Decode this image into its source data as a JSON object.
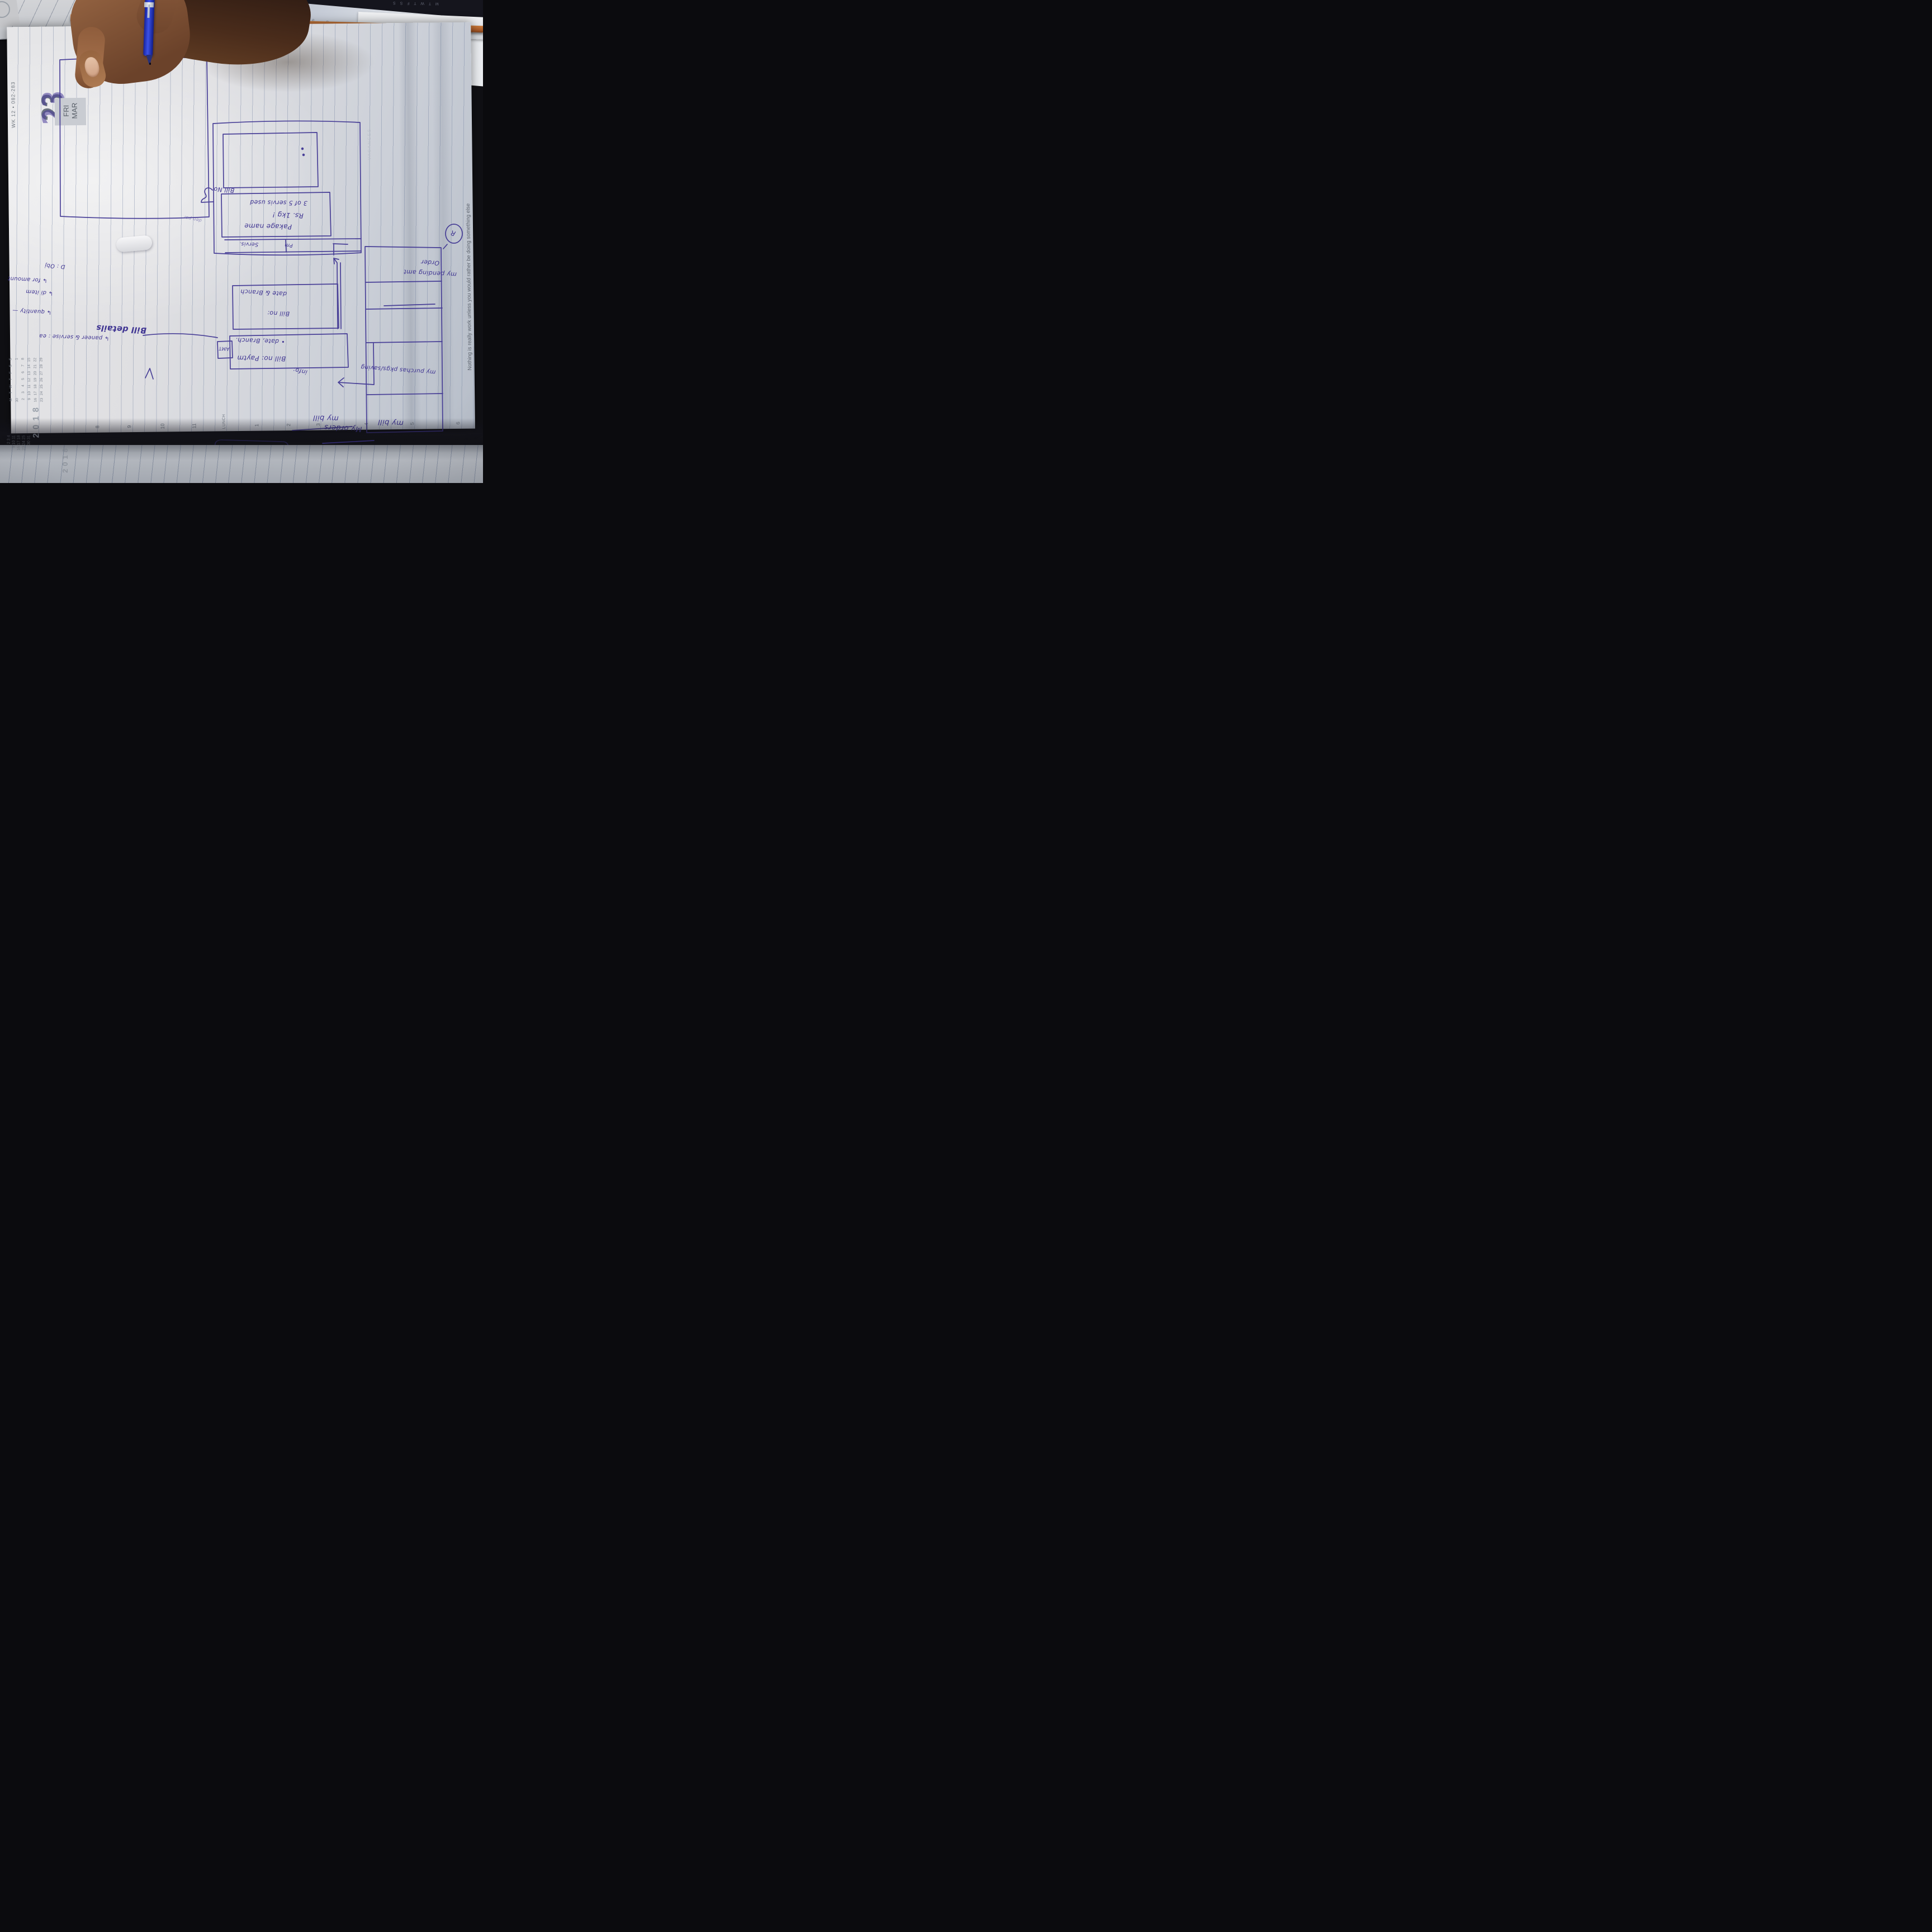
{
  "planner": {
    "day_number": "23",
    "weekday": "FRI",
    "month": "MAR",
    "week_page_label": "WK 12 • 082-283",
    "year": "2018",
    "vacances_label": "VACANCES",
    "quote": "Nothing is really work unless you would rather be doing something else",
    "mini_calendar": {
      "headers": [
        "M",
        "T",
        "W",
        "T",
        "F",
        "S",
        "S"
      ],
      "weeks": [
        [
          "30",
          "",
          "",
          "",
          "",
          "",
          "1"
        ],
        [
          "2",
          "3",
          "4",
          "5",
          "6",
          "7",
          "8"
        ],
        [
          "9",
          "10",
          "11",
          "12",
          "13",
          "14",
          "15"
        ],
        [
          "16",
          "17",
          "18",
          "19",
          "20",
          "21",
          "22"
        ],
        [
          "23",
          "24",
          "25",
          "26",
          "27",
          "28",
          "29"
        ]
      ]
    },
    "next_page_calendar_lines": [
      "2 3 4",
      "9 10 11",
      "16 17 18",
      "23 24 25",
      "30 31"
    ],
    "next_page_year": "2018",
    "hours": [
      "8",
      "9",
      "10",
      "11",
      "LUNCH",
      "1",
      "2",
      "3",
      "4",
      "5",
      "6"
    ],
    "top_edge_days": "M T W T F S",
    "top_edge_days_right": "M T W T F S S",
    "top_edge_numbers": "1 2 3 4 5 6 7 8 9"
  },
  "sketch": {
    "menu_screen": {
      "row_bill": "my bill",
      "row_purchase": "my purchas pkgs/saving",
      "row_pending": "my pending amt",
      "row_order": "Order"
    },
    "bill_screen": {
      "title": "my bill",
      "info_label": "info:",
      "row1_line1": "Bill no: Paytm",
      "row1_line2": "• date, Branch.",
      "amt_label": "AMT",
      "row2_line1": "Bill no:",
      "row2_line2": "date & Branch"
    },
    "package_screen": {
      "bill_no_label": "Bill No",
      "name_line": "Pakage name",
      "qty_line": "Rs. 1kg !",
      "usage_line": "3 of 5 servis used",
      "footer_left": "Servis.",
      "footer_right": "Pm"
    },
    "annotations": {
      "bill_details_label": "Bill details",
      "note_1": "↳ paneer & servise : ea",
      "note_2": "↳ quantity —",
      "note_3": "↳ di item",
      "note_4": "↳ for amount",
      "note_5": "D : Obj",
      "orders_title": "My orders",
      "margin_scribble": "den par",
      "corner_mark": "R",
      "lower_scribble": "My"
    }
  }
}
